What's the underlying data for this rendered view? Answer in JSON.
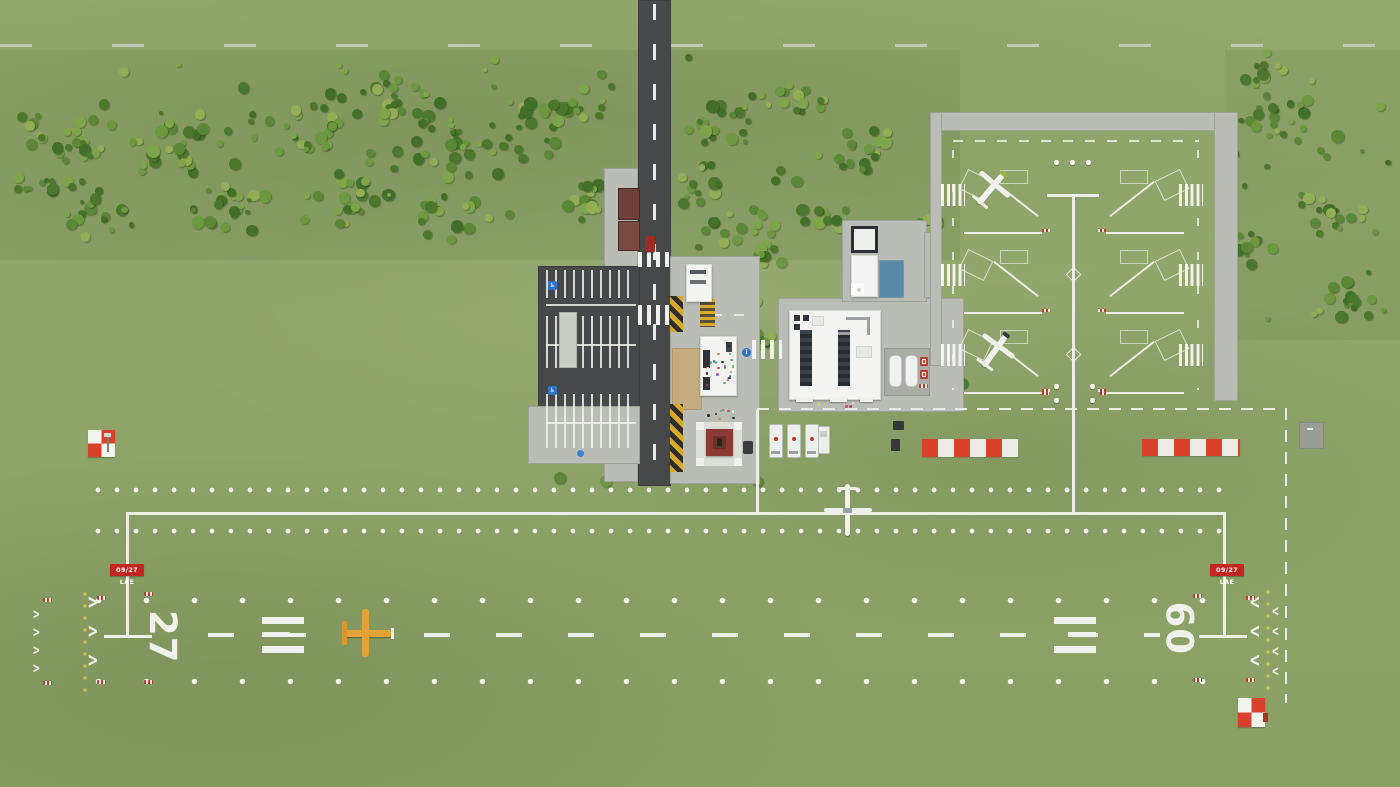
{
  "scene": {
    "description": "Top-down overview of a small general-aviation grass airfield in an airport tycoon game",
    "grass": "#90a56b",
    "asphalt": "#46484a",
    "pavement": "#b9bdb5",
    "marking_white": "#f0f1ec",
    "edge_light_yellow": "#d6c14b",
    "hazard_yellow": "#d9a92c",
    "checker_red": "#d8422a",
    "sign_red": "#c4261f",
    "gazebo_roof_red": "#8a3b34",
    "pool_blue": "#5b8aa8",
    "plane_yellow": "#e2a238",
    "tree_colors": [
      "#4c782e",
      "#5b8836",
      "#6c993f",
      "#7fa54a",
      "#93ad55",
      "#42702a"
    ]
  },
  "runway": {
    "id_west": "27",
    "id_east": "09",
    "sign_west": "09/27 LAE",
    "sign_east": "09/27 LAE"
  },
  "icons": {
    "handicap": "♿",
    "info": "i"
  }
}
